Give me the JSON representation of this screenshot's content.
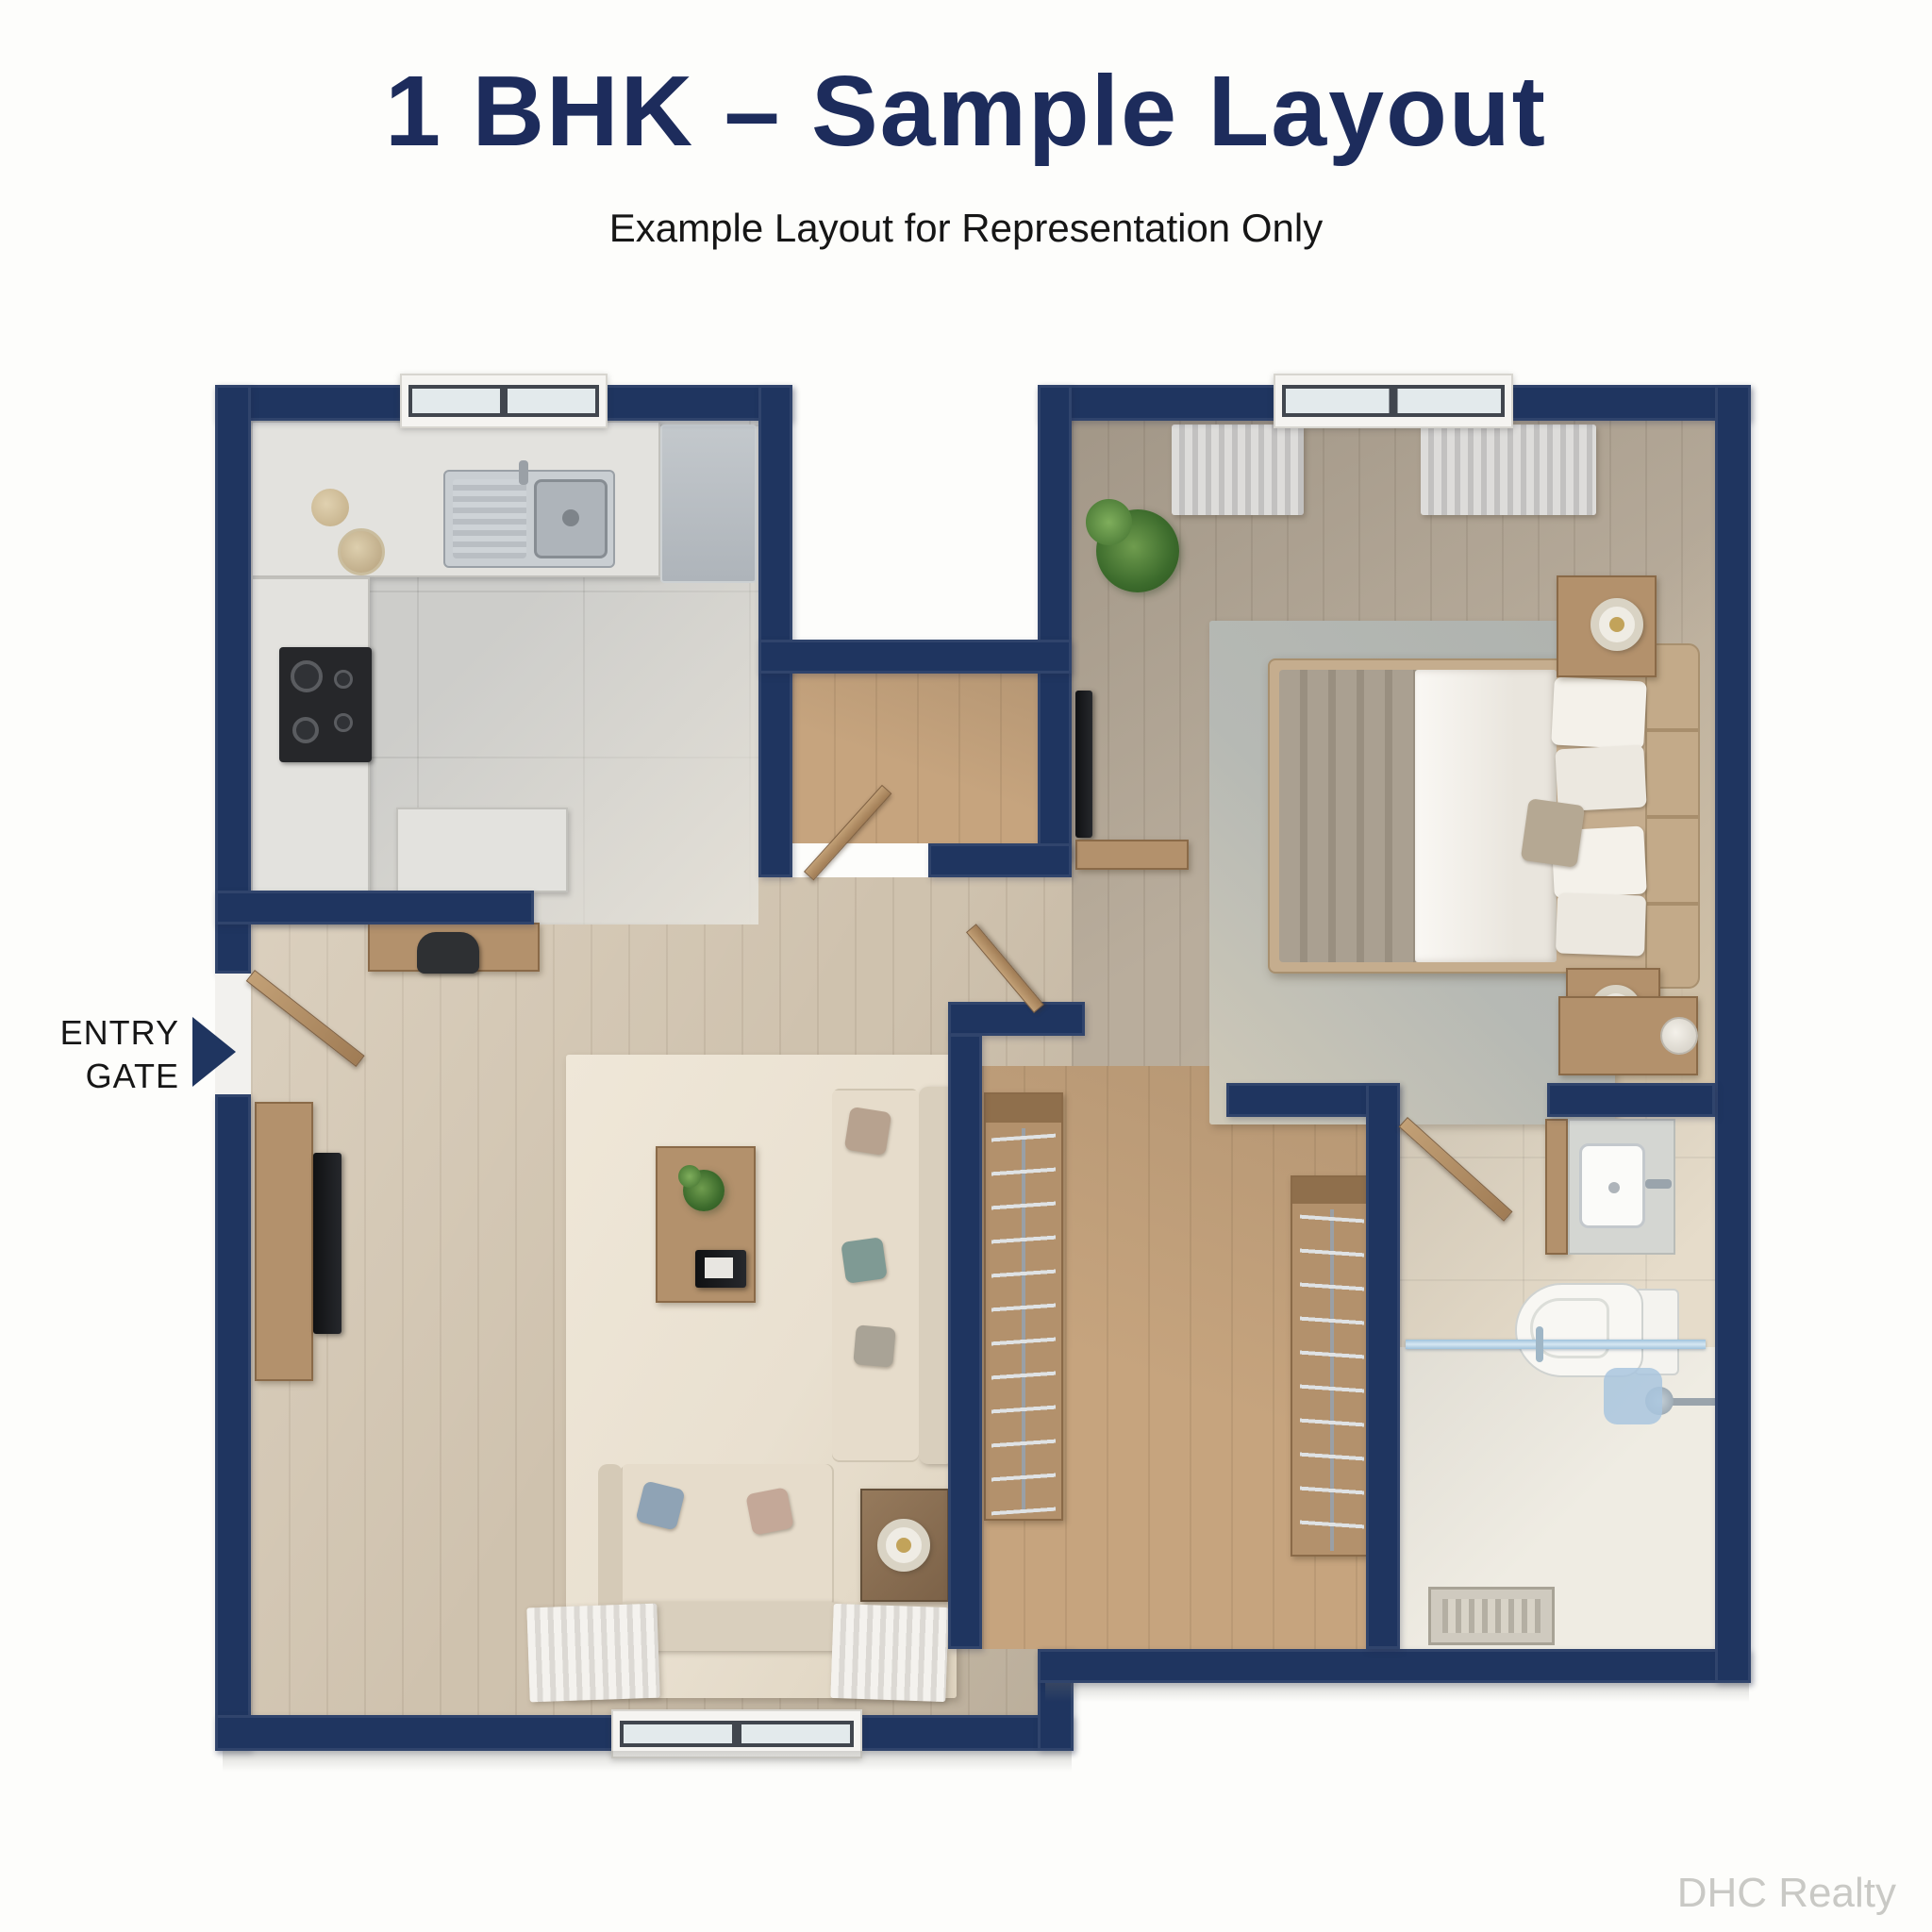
{
  "page": {
    "title": "1 BHK – Sample Layout",
    "subtitle": "Example Layout for Representation Only",
    "watermark": "DHC Realty"
  },
  "labels": {
    "entry_line1": "ENTRY",
    "entry_line2": "GATE"
  },
  "plan": {
    "type": "apartment-floor-plan",
    "unit": "1 BHK",
    "rooms_depicted": [
      "kitchen",
      "living-room",
      "foyer",
      "bedroom",
      "walk-in-wardrobe",
      "bathroom",
      "entry-hall"
    ],
    "fixtures_depicted": [
      "kitchen-sink",
      "gas-hob",
      "refrigerator",
      "breakfast-counter",
      "study-desk-with-chair",
      "tv-unit",
      "l-shaped-sofa",
      "coffee-table-with-plant",
      "side-table-with-lamp",
      "double-bed",
      "nightstands-with-lamps",
      "wall-tv",
      "dresser",
      "wardrobe-hanger-rails",
      "wash-basin",
      "toilet",
      "shower-with-glass-partition",
      "floor-drain",
      "windows",
      "curtains",
      "entry-door",
      "internal-doors",
      "potted-plants"
    ]
  },
  "colors": {
    "wall_navy": "#1f3560",
    "title_navy": "#1d2c5c",
    "text_black": "#161616",
    "wood_light": "#cfc2ae",
    "wood_tan": "#c6a47e",
    "wood_gray": "#b9ad9c",
    "tile_gray": "#cdcdca",
    "bath_beige": "#e6dcca",
    "shower_white": "#efece3",
    "rug_cream": "#e9e0d0",
    "rug_gray": "#b6b9b4",
    "counter": "#e3e2de",
    "wood_furn": "#b3916c",
    "sofa": "#e6dccb",
    "watermark": "#c9c9c5"
  }
}
